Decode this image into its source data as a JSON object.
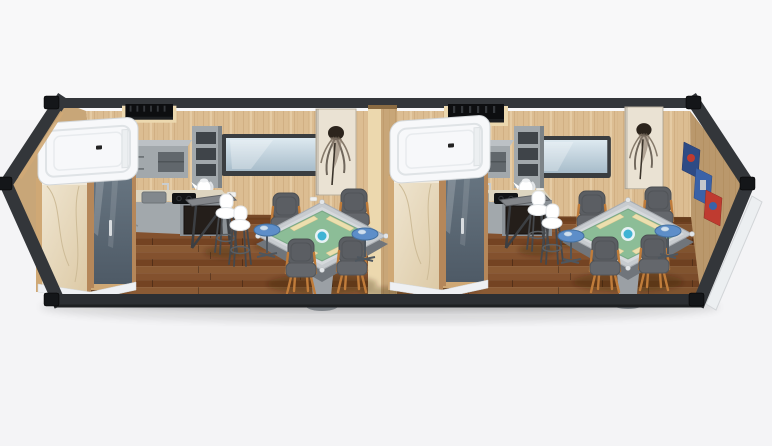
{
  "scene": {
    "type": "3d-render",
    "subject": "prefab-container-house-two-unit-interior-cutaway",
    "background": "plain-light-studio",
    "container": {
      "frame": "dark-steel-with-corner-castings",
      "floor": "brown-wood-planks",
      "walls": "light-oak-panels"
    },
    "units": [
      {
        "name": "unit-1",
        "objects": [
          "bathroom-pod",
          "glass-shower-door",
          "marble-panel",
          "wall-closet-recess",
          "kitchenette",
          "upper-cabinet",
          "open-shelf-column",
          "kettle",
          "sink",
          "induction-cooktop",
          "mini-fridge",
          "bar-table",
          "bar-stool",
          "bar-stool",
          "window",
          "flower-art-panel",
          "mahjong-table",
          "armchair",
          "armchair",
          "armchair",
          "armchair",
          "side-table",
          "side-table",
          "wall-socket"
        ]
      },
      {
        "name": "unit-2",
        "objects": [
          "bathroom-pod",
          "glass-shower-door",
          "marble-panel",
          "wall-closet-recess",
          "kitchenette",
          "upper-cabinet",
          "open-shelf-column",
          "kettle",
          "sink",
          "induction-cooktop",
          "mini-fridge",
          "bar-table",
          "bar-stool",
          "bar-stool",
          "window",
          "flower-art-panel",
          "mahjong-table",
          "armchair",
          "armchair",
          "armchair",
          "armchair",
          "side-table",
          "side-table",
          "wall-socket",
          "poster-art-wall"
        ]
      }
    ]
  },
  "palette": {
    "bg": "#f4f4f6",
    "frame": "#33363a",
    "casting": "#141619",
    "wall": "#dcbd92",
    "wallLit": "#ecd8ae",
    "wallDark": "#c8a678",
    "trimLight": "#cfa875",
    "floorA": "#83512e",
    "floorB": "#744322",
    "floorC": "#8a5a34",
    "bronze": "#b5875a",
    "podWhite": "#f7f8fa",
    "marbleA": "#efe5d0",
    "marbleB": "#dcc9a5",
    "cab": "#a2a8ac",
    "cabLight": "#bcc1c5",
    "cabDark": "#8b9196",
    "counter": "#ddd5c0",
    "glassA": "#dde9f0",
    "glassB": "#a7bcca",
    "doorA": "#6a7884",
    "doorB": "#4e5a66",
    "silver": "#c7cbcf",
    "felt": "#8cbd97",
    "rack": "#ecdfae",
    "mblue": "#3fb3d4",
    "chairBody": "#5b5e63",
    "chairWood": "#c07c3a",
    "btable": "#5d8ec9",
    "artBg": "#eae2d3",
    "posterBlue": "#2e4b85",
    "posterBlue2": "#3a62a8",
    "posterRed": "#bf3b30",
    "endWhite": "#eceff1"
  }
}
